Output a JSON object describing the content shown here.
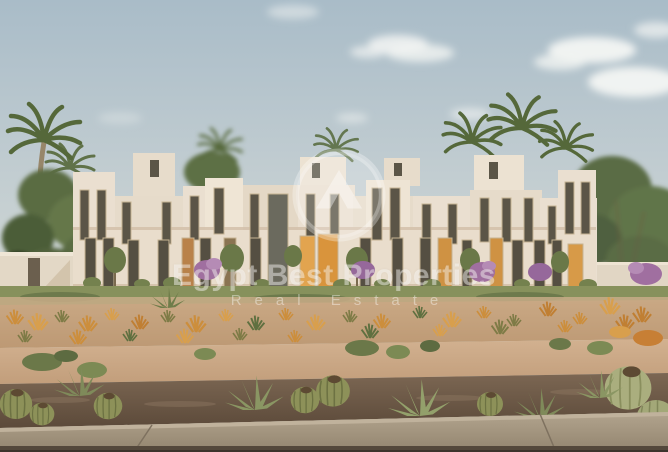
{
  "meta": {
    "type": "architectural-rendering",
    "subject": "Row of cream two-storey desert townhouses with palm trees, desert planting and barrel cacti in the foreground"
  },
  "watermark": {
    "title": "Egypt Best Properties",
    "subtitle": "Real Estate",
    "logo_icon": "mountain-peak-in-circle"
  },
  "palette": {
    "sky_top": "#a9bcc8",
    "sky_horizon": "#cfd8d6",
    "cloud_white": "#f3f5f3",
    "building_cream": "#e9dfd0",
    "building_shade": "#d6c5b0",
    "window_dark": "#5b5547",
    "door_amber": "#dda04e",
    "lawn_green": "#87915c",
    "grass_orange": "#cc8e3c",
    "sand": "#c9a884",
    "gravel_brown": "#6b5743",
    "sidewalk_grey": "#a6987f",
    "foliage_green": "#5d6f44",
    "bougainvillea_purple": "#a06fa0",
    "watermark_white": "rgba(255,255,255,0.42)"
  }
}
